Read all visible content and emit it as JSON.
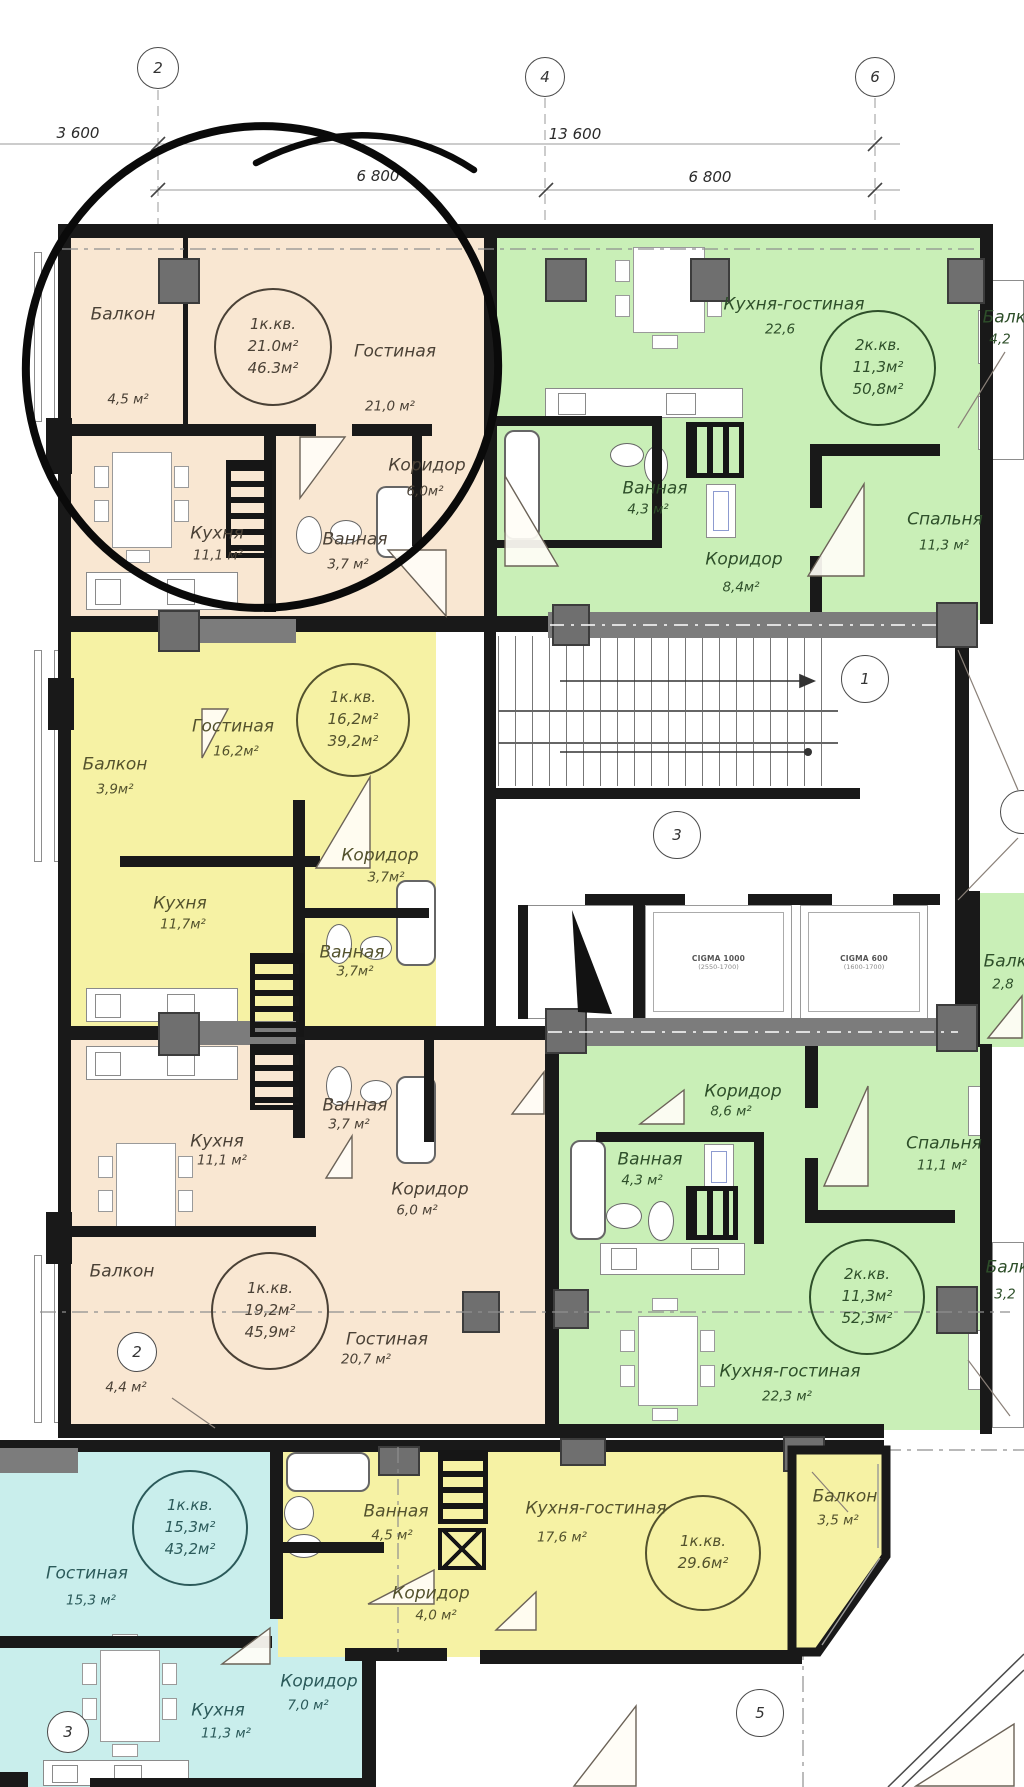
{
  "plan": {
    "grid_markers_top": [
      {
        "label": "2"
      },
      {
        "label": "4"
      },
      {
        "label": "6"
      }
    ],
    "plan_markers": [
      {
        "label": "1"
      },
      {
        "label": "3"
      },
      {
        "label": "2"
      },
      {
        "label": "3"
      },
      {
        "label": "5"
      }
    ],
    "dimensions": {
      "row1_left": "3 600",
      "row1_right": "13 600",
      "row2_left": "6 800",
      "row2_right": "6 800"
    },
    "colors": {
      "apartment_peach": "#f9e7d2",
      "apartment_green": "#c9efb7",
      "apartment_yellow": "#f6f2a4",
      "apartment_cyan": "#c9eeec",
      "walls": "#191919",
      "columns": "#6f6f6f"
    },
    "elevators": [
      {
        "model": "CIGMA 1000",
        "dims": "(2550-1700)"
      },
      {
        "model": "CIGMA 600",
        "dims": "(1600-1700)"
      }
    ],
    "edge_rooms": [
      {
        "name": "Балкон",
        "area": "2,8"
      }
    ],
    "apartments": [
      {
        "id": "apt-1-peach-top",
        "unit": {
          "type": "1к.кв.",
          "a1": "21.0м²",
          "a2": "46.3м²"
        },
        "color": "#f9e7d2",
        "rooms": [
          {
            "name": "Балкон",
            "area": "4,5 м²"
          },
          {
            "name": "Гостиная",
            "area": "21,0 м²"
          },
          {
            "name": "Коридор",
            "area": "6,0м²"
          },
          {
            "name": "Кухня",
            "area": "11,1 м²"
          },
          {
            "name": "Ванная",
            "area": "3,7 м²"
          }
        ]
      },
      {
        "id": "apt-2-green-top",
        "unit": {
          "type": "2к.кв.",
          "a1": "11,3м²",
          "a2": "50,8м²"
        },
        "color": "#c9efb7",
        "rooms": [
          {
            "name": "Кухня-гостиная",
            "area": "22,6"
          },
          {
            "name": "Балкон",
            "area": "4,2"
          },
          {
            "name": "Ванная",
            "area": "4,3 м²"
          },
          {
            "name": "Коридор",
            "area": "8,4м²"
          },
          {
            "name": "Спальня",
            "area": "11,3 м²"
          }
        ]
      },
      {
        "id": "apt-3-yellow-mid",
        "unit": {
          "type": "1к.кв.",
          "a1": "16,2м²",
          "a2": "39,2м²"
        },
        "color": "#f6f2a4",
        "rooms": [
          {
            "name": "Гостиная",
            "area": "16,2м²"
          },
          {
            "name": "Балкон",
            "area": "3,9м²"
          },
          {
            "name": "Коридор",
            "area": "3,7м²"
          },
          {
            "name": "Кухня",
            "area": "11,7м²"
          },
          {
            "name": "Ванная",
            "area": "3,7м²"
          }
        ]
      },
      {
        "id": "apt-4-peach-mid",
        "unit": {
          "type": "1к.кв.",
          "a1": "19,2м²",
          "a2": "45,9м²"
        },
        "color": "#f9e7d2",
        "rooms": [
          {
            "name": "Ванная",
            "area": "3,7 м²"
          },
          {
            "name": "Кухня",
            "area": "11,1 м²"
          },
          {
            "name": "Коридор",
            "area": "6,0 м²"
          },
          {
            "name": "Балкон",
            "area": "4,4 м²"
          },
          {
            "name": "Гостиная",
            "area": "20,7 м²"
          }
        ]
      },
      {
        "id": "apt-5-green-mid",
        "unit": {
          "type": "2к.кв.",
          "a1": "11,3м²",
          "a2": "52,3м²"
        },
        "color": "#c9efb7",
        "rooms": [
          {
            "name": "Коридор",
            "area": "8,6 м²"
          },
          {
            "name": "Ванная",
            "area": "4,3 м²"
          },
          {
            "name": "Спальня",
            "area": "11,1 м²"
          },
          {
            "name": "Кухня-гостиная",
            "area": "22,3 м²"
          },
          {
            "name": "Балкон",
            "area": "3,2"
          }
        ]
      },
      {
        "id": "apt-6-cyan-bottom",
        "unit": {
          "type": "1к.кв.",
          "a1": "15,3м²",
          "a2": "43,2м²"
        },
        "color": "#c9eeec",
        "rooms": [
          {
            "name": "Гостиная",
            "area": "15,3 м²"
          },
          {
            "name": "Кухня",
            "area": "11,3 м²"
          },
          {
            "name": "Коридор",
            "area": "7,0 м²"
          }
        ]
      },
      {
        "id": "apt-7-yellow-bottom",
        "unit": {
          "type": "1к.кв.",
          "a1": "29.6м²"
        },
        "color": "#f6f2a4",
        "rooms": [
          {
            "name": "Ванная",
            "area": "4,5 м²"
          },
          {
            "name": "Коридор",
            "area": "4,0 м²"
          },
          {
            "name": "Кухня-гостиная",
            "area": "17,6 м²"
          },
          {
            "name": "Балкон",
            "area": "3,5 м²"
          }
        ]
      }
    ]
  }
}
